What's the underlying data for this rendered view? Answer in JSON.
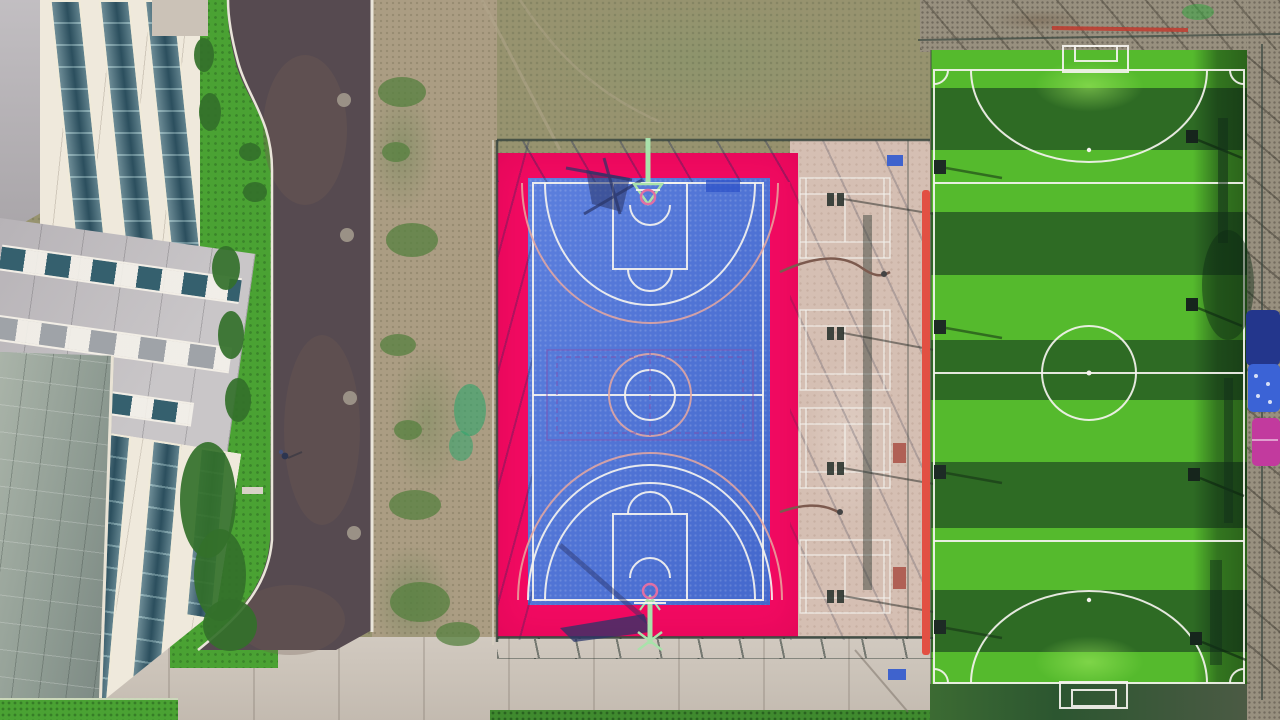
{
  "palette": {
    "scrub": "#97936f",
    "scrub-green": "#7f9a68",
    "dirt": "#ab9d83",
    "gravel": "#98907f",
    "road": "#564a50",
    "road-light": "#6f5c54",
    "curb": "#eae5da",
    "pavement": "#cbc2b7",
    "beige-court": "#d5bfb3",
    "court-pink": "#f30a62",
    "court-blue": "#4a71da",
    "line-white": "#f5f3ef",
    "line-salmon": "#e8a89f",
    "line-purple": "#8052b0",
    "grass-bright": "#55ba2d",
    "grass-dark": "#2e6b24",
    "lawn": "#4aa233",
    "hedge": "#33702a",
    "cream": "#efe9dc",
    "panel-gray": "#b7b3b7",
    "panel-gray-light": "#c9c6c8",
    "glass": "#35606e",
    "glass-light": "#76a0a8",
    "atrium": "#9ba89e",
    "mint": "#a9e2ab",
    "rim-pink": "#e06fa4",
    "shadow-navy": "#2a3468",
    "fence": "#3a473f",
    "red-strip": "#e25043",
    "canopy-navy": "#23368c",
    "canopy-blue": "#3b63d6",
    "canopy-magenta": "#c23a9e",
    "bench-blue": "#3f63cd",
    "bench-red": "#b06055"
  },
  "field": {
    "top": 50,
    "height": 634,
    "stripes": [
      {
        "y": 0,
        "h": 38,
        "tone": "bright"
      },
      {
        "y": 38,
        "h": 62,
        "tone": "dark"
      },
      {
        "y": 100,
        "h": 62,
        "tone": "bright"
      },
      {
        "y": 162,
        "h": 63,
        "tone": "dark"
      },
      {
        "y": 225,
        "h": 65,
        "tone": "bright"
      },
      {
        "y": 290,
        "h": 60,
        "tone": "dark"
      },
      {
        "y": 350,
        "h": 62,
        "tone": "bright"
      },
      {
        "y": 412,
        "h": 66,
        "tone": "dark"
      },
      {
        "y": 478,
        "h": 62,
        "tone": "bright"
      },
      {
        "y": 540,
        "h": 62,
        "tone": "dark"
      },
      {
        "y": 602,
        "h": 32,
        "tone": "bright"
      }
    ]
  },
  "scene": {
    "type": "aerial-photograph",
    "areas": [
      {
        "name": "office-building",
        "desc": "cream facade, teal glass curtain-wall strips, gray wing with window rows, glass atrium roof"
      },
      {
        "name": "access-road",
        "desc": "dark asphalt, white curbs, four manholes, one pedestrian"
      },
      {
        "name": "scrub-ground",
        "desc": "patchy dirt and weeds around fenced courts"
      },
      {
        "name": "basketball-court",
        "desc": "blue tile court with magenta surround, two hoops, white and salmon markings, purple volleyball overlay at centre"
      },
      {
        "name": "badminton-strip",
        "desc": "four white-lined courts on pink-beige concrete, light-pole shadows, benches, hoses"
      },
      {
        "name": "soccer-field",
        "desc": "striped artificial turf, white futsal markings, two goals, red side strip, floodlights, shade canopies"
      },
      {
        "name": "pavement",
        "desc": "concrete apron with fence shadow grid and lawn edges"
      }
    ]
  }
}
